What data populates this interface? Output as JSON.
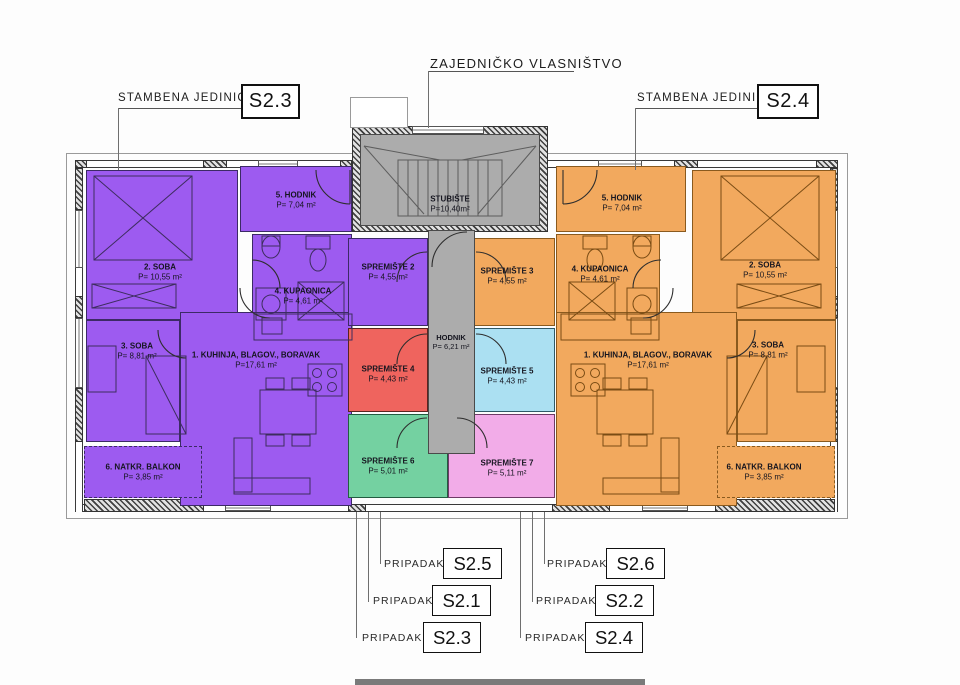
{
  "header": {
    "common_ownership_label": "ZAJEDNIČKO VLASNIŠTVO",
    "left_unit": {
      "label": "STAMBENA JEDINICA",
      "code": "S2.3"
    },
    "right_unit": {
      "label": "STAMBENA JEDINICA",
      "code": "S2.4"
    }
  },
  "common_areas": {
    "staircase": {
      "name": "STUBIŠTE",
      "area": "P=10,40m²"
    },
    "corridor": {
      "name": "HODNIK",
      "area": "P= 6,21 m²"
    }
  },
  "apartment_left": {
    "code": "S2.3",
    "rooms": {
      "kitchen": {
        "name": "1. KUHINJA, BLAGOV., BORAVAK",
        "area": "P=17,61 m²"
      },
      "room2": {
        "name": "2. SOBA",
        "area": "P= 10,55 m²"
      },
      "room3": {
        "name": "3. SOBA",
        "area": "P= 8,81 m²"
      },
      "bathroom": {
        "name": "4. KUPAONICA",
        "area": "P= 4,61 m²"
      },
      "hallway": {
        "name": "5. HODNIK",
        "area": "P= 7,04 m²"
      },
      "balcony": {
        "name": "6. NATKR. BALKON",
        "area": "P= 3,85 m²"
      }
    }
  },
  "apartment_right": {
    "code": "S2.4",
    "rooms": {
      "kitchen": {
        "name": "1. KUHINJA, BLAGOV., BORAVAK",
        "area": "P=17,61 m²"
      },
      "room2": {
        "name": "2. SOBA",
        "area": "P= 10,55 m²"
      },
      "room3": {
        "name": "3. SOBA",
        "area": "P= 8,81 m²"
      },
      "bathroom": {
        "name": "4. KUPAONICA",
        "area": "P= 4,61 m²"
      },
      "hallway": {
        "name": "5. HODNIK",
        "area": "P= 7,04 m²"
      },
      "balcony": {
        "name": "6. NATKR. BALKON",
        "area": "P= 3,85 m²"
      }
    }
  },
  "storages": {
    "s2": {
      "name": "SPREMIŠTE 2",
      "area": "P= 4,55 m²",
      "color": "#9d5bf0"
    },
    "s3": {
      "name": "SPREMIŠTE 3",
      "area": "P= 4,55 m²",
      "color": "#f2a95e"
    },
    "s4": {
      "name": "SPREMIŠTE 4",
      "area": "P= 4,43 m²",
      "color": "#ef645e"
    },
    "s5": {
      "name": "SPREMIŠTE 5",
      "area": "P= 4,43 m²",
      "color": "#abe0f2"
    },
    "s6": {
      "name": "SPREMIŠTE 6",
      "area": "P= 5,01 m²",
      "color": "#74d1a1"
    },
    "s7": {
      "name": "SPREMIŠTE 7",
      "area": "P= 5,11 m²",
      "color": "#f2ace8"
    }
  },
  "footer_labels": {
    "left": [
      {
        "label": "PRIPADAK",
        "code": "S2.5"
      },
      {
        "label": "PRIPADAK",
        "code": "S2.1"
      },
      {
        "label": "PRIPADAK",
        "code": "S2.3"
      }
    ],
    "right": [
      {
        "label": "PRIPADAK",
        "code": "S2.6"
      },
      {
        "label": "PRIPADAK",
        "code": "S2.2"
      },
      {
        "label": "PRIPADAK",
        "code": "S2.4"
      }
    ]
  },
  "colors": {
    "common_gray": "#acacac",
    "left_purple": "#9d5bf0",
    "right_orange": "#f2a95e"
  }
}
